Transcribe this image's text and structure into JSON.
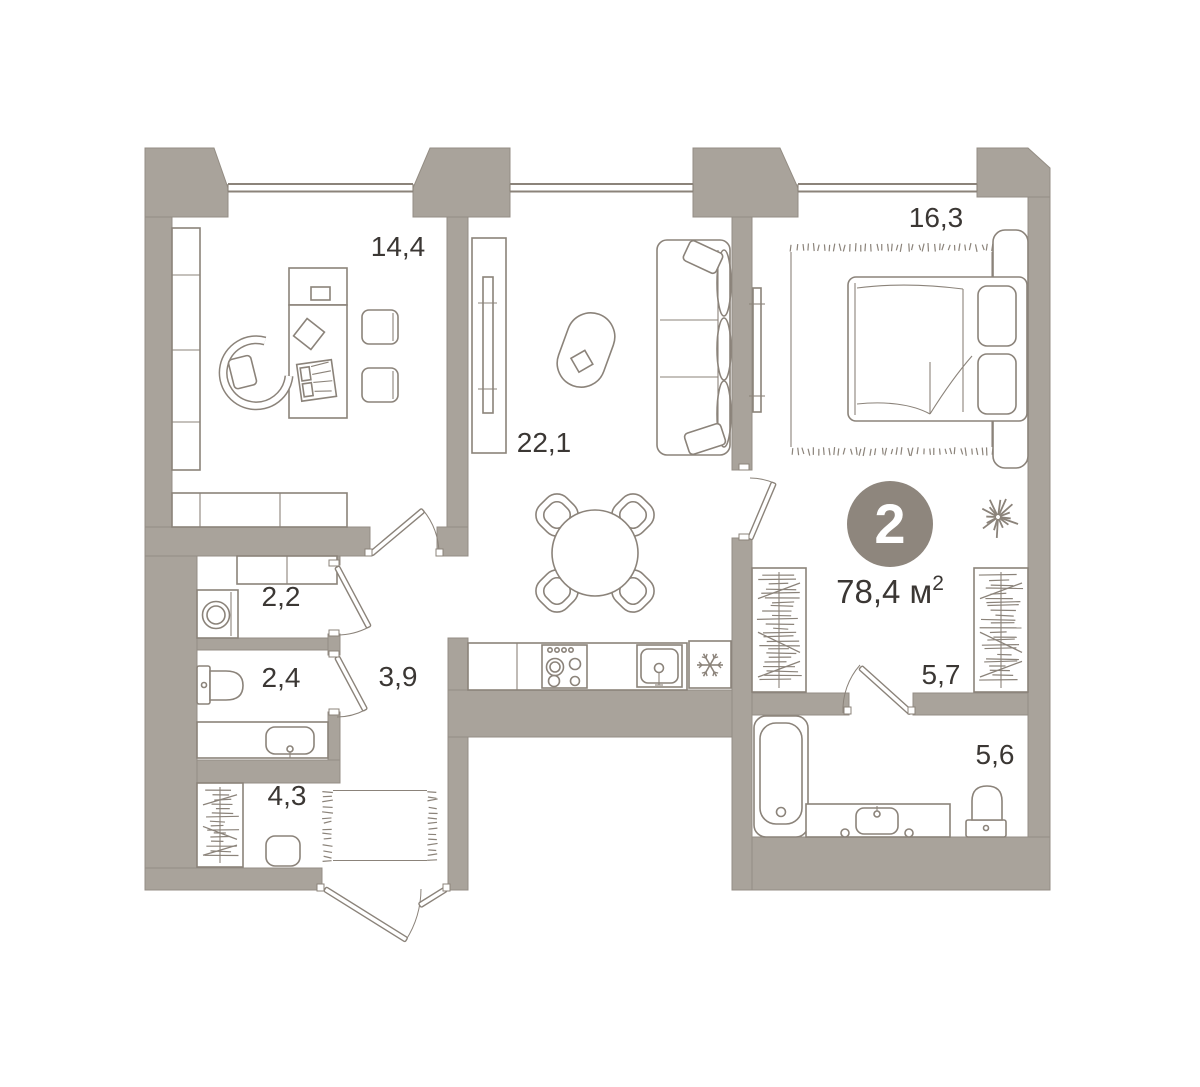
{
  "badge": {
    "value": "2"
  },
  "total_area": {
    "text": "78,4 м",
    "sup": "2"
  },
  "rooms": {
    "office": {
      "area": "14,4"
    },
    "living_kitchen": {
      "area": "22,1"
    },
    "bedroom": {
      "area": "16,3"
    },
    "laundry": {
      "area": "2,2"
    },
    "wc": {
      "area": "2,4"
    },
    "hallway": {
      "area": "3,9"
    },
    "entry": {
      "area": "4,3"
    },
    "walk_in_closet": {
      "area": "5,7"
    },
    "bathroom": {
      "area": "5,6"
    }
  },
  "icons": {
    "fridge": "snowflake-icon",
    "bedroom_decor": "plant-icon"
  },
  "colors": {
    "background": "#ffffff",
    "wall": "#a9a39b",
    "wall_edge": "#948d84",
    "line": "#8b837a",
    "text": "#3b3734",
    "badge_fill": "#8e867d",
    "badge_text": "#ffffff"
  }
}
